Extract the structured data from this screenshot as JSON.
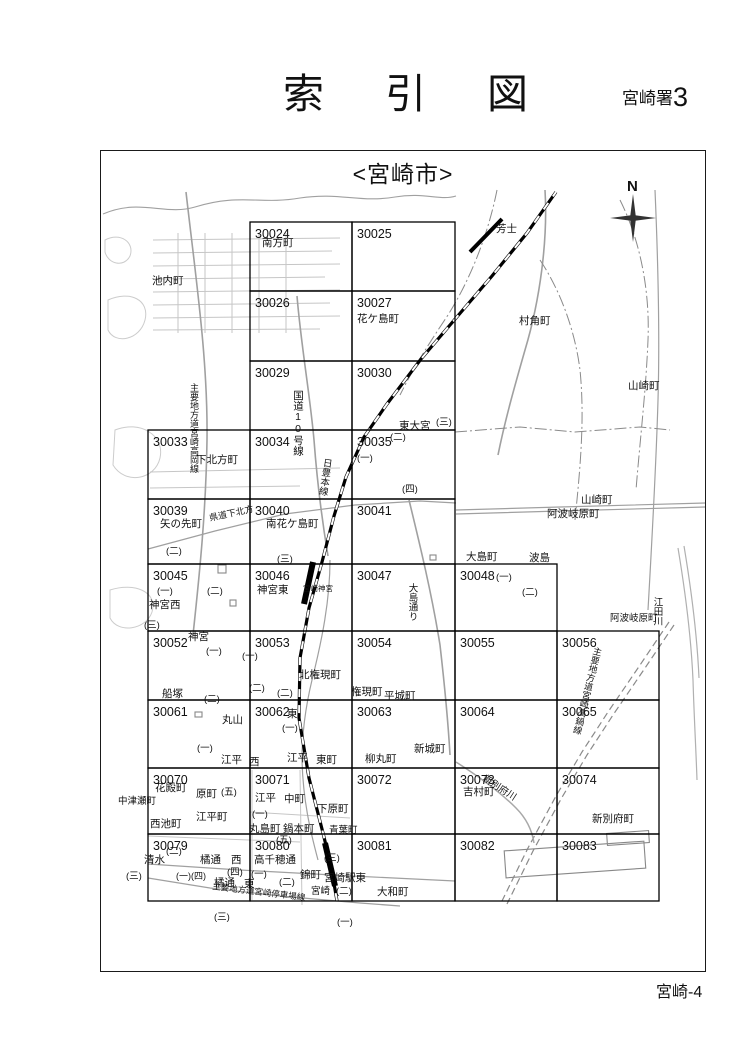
{
  "header": {
    "title": "索　引　図",
    "office": "宮崎署",
    "office_number": "3"
  },
  "map": {
    "title": "<宮崎市>",
    "compass": "N",
    "page_label": "宮崎-4"
  },
  "grid": {
    "cols": [
      148,
      250,
      352,
      455,
      557,
      659
    ],
    "rows": [
      222,
      291,
      361,
      430,
      499,
      564,
      631,
      700,
      768,
      834,
      901
    ],
    "cells": [
      {
        "no": "30024",
        "c": 1,
        "r": 0
      },
      {
        "no": "30025",
        "c": 2,
        "r": 0
      },
      {
        "no": "30026",
        "c": 1,
        "r": 1
      },
      {
        "no": "30027",
        "c": 2,
        "r": 1
      },
      {
        "no": "30029",
        "c": 1,
        "r": 2
      },
      {
        "no": "30030",
        "c": 2,
        "r": 2
      },
      {
        "no": "30033",
        "c": 0,
        "r": 3
      },
      {
        "no": "30034",
        "c": 1,
        "r": 3
      },
      {
        "no": "30035",
        "c": 2,
        "r": 3
      },
      {
        "no": "30039",
        "c": 0,
        "r": 4
      },
      {
        "no": "30040",
        "c": 1,
        "r": 4
      },
      {
        "no": "30041",
        "c": 2,
        "r": 4
      },
      {
        "no": "30045",
        "c": 0,
        "r": 5
      },
      {
        "no": "30046",
        "c": 1,
        "r": 5
      },
      {
        "no": "30047",
        "c": 2,
        "r": 5
      },
      {
        "no": "30048",
        "c": 3,
        "r": 5
      },
      {
        "no": "30052",
        "c": 0,
        "r": 6
      },
      {
        "no": "30053",
        "c": 1,
        "r": 6
      },
      {
        "no": "30054",
        "c": 2,
        "r": 6
      },
      {
        "no": "30055",
        "c": 3,
        "r": 6
      },
      {
        "no": "30056",
        "c": 4,
        "r": 6
      },
      {
        "no": "30061",
        "c": 0,
        "r": 7
      },
      {
        "no": "30062",
        "c": 1,
        "r": 7
      },
      {
        "no": "30063",
        "c": 2,
        "r": 7
      },
      {
        "no": "30064",
        "c": 3,
        "r": 7
      },
      {
        "no": "30065",
        "c": 4,
        "r": 7
      },
      {
        "no": "30070",
        "c": 0,
        "r": 8
      },
      {
        "no": "30071",
        "c": 1,
        "r": 8
      },
      {
        "no": "30072",
        "c": 2,
        "r": 8
      },
      {
        "no": "30073",
        "c": 3,
        "r": 8
      },
      {
        "no": "30074",
        "c": 4,
        "r": 8
      },
      {
        "no": "30079",
        "c": 0,
        "r": 9
      },
      {
        "no": "30080",
        "c": 1,
        "r": 9
      },
      {
        "no": "30081",
        "c": 2,
        "r": 9
      },
      {
        "no": "30082",
        "c": 3,
        "r": 9
      },
      {
        "no": "30083",
        "c": 4,
        "r": 9
      }
    ]
  },
  "labels": [
    {
      "t": "南方町",
      "x": 262,
      "y": 246
    },
    {
      "t": "池内町",
      "x": 152,
      "y": 284
    },
    {
      "t": "芳士",
      "x": 496,
      "y": 232
    },
    {
      "t": "村角町",
      "x": 519,
      "y": 324
    },
    {
      "t": "花ケ島町",
      "x": 357,
      "y": 322
    },
    {
      "t": "山崎町",
      "x": 628,
      "y": 389
    },
    {
      "t": "国道10号線",
      "x": 298,
      "y": 390,
      "v": 1
    },
    {
      "t": "主要地方道宮崎高岡線",
      "x": 194,
      "y": 383,
      "v": 1,
      "s": 9
    },
    {
      "t": "下北方町",
      "x": 196,
      "y": 463
    },
    {
      "t": "東大宮",
      "x": 399,
      "y": 429
    },
    {
      "t": "(三)",
      "x": 436,
      "y": 425,
      "s": 9.5
    },
    {
      "t": "(二)",
      "x": 390,
      "y": 440,
      "s": 9.5
    },
    {
      "t": "(一)",
      "x": 357,
      "y": 461,
      "s": 9.5
    },
    {
      "t": "(四)",
      "x": 402,
      "y": 492,
      "s": 9.5
    },
    {
      "t": "矢の先町",
      "x": 160,
      "y": 527
    },
    {
      "t": "(二)",
      "x": 166,
      "y": 554,
      "s": 9.5
    },
    {
      "t": "県道下北方",
      "x": 210,
      "y": 521,
      "r": -12,
      "s": 9
    },
    {
      "t": "南花ケ島町",
      "x": 266,
      "y": 527
    },
    {
      "t": "(三)",
      "x": 277,
      "y": 562,
      "s": 9.5
    },
    {
      "t": "日豊本線",
      "x": 327,
      "y": 458,
      "v": 1,
      "s": 9.5,
      "r": 8
    },
    {
      "t": "大島町",
      "x": 466,
      "y": 560
    },
    {
      "t": "波島",
      "x": 529,
      "y": 561
    },
    {
      "t": "阿波岐原町",
      "x": 547,
      "y": 517
    },
    {
      "t": "山崎町",
      "x": 581,
      "y": 503
    },
    {
      "t": "(一)",
      "x": 157,
      "y": 594,
      "s": 9.5
    },
    {
      "t": "神宮西",
      "x": 149,
      "y": 608
    },
    {
      "t": "(二)",
      "x": 207,
      "y": 594,
      "s": 9.5
    },
    {
      "t": "(三)",
      "x": 144,
      "y": 628,
      "s": 9.5
    },
    {
      "t": "神宮東",
      "x": 257,
      "y": 593
    },
    {
      "t": "宮崎神宮",
      "x": 303,
      "y": 591,
      "s": 7.5
    },
    {
      "t": "大島通り",
      "x": 412,
      "y": 583,
      "v": 1,
      "s": 9.5
    },
    {
      "t": "(一)",
      "x": 496,
      "y": 580,
      "s": 9.5
    },
    {
      "t": "(二)",
      "x": 522,
      "y": 595,
      "s": 9.5
    },
    {
      "t": "阿波岐原町",
      "x": 610,
      "y": 621,
      "s": 9.5
    },
    {
      "t": "江田川",
      "x": 657,
      "y": 597,
      "v": 1,
      "s": 9.5
    },
    {
      "t": "神宮",
      "x": 188,
      "y": 640
    },
    {
      "t": "(一)",
      "x": 206,
      "y": 654,
      "s": 9.5
    },
    {
      "t": "(一)",
      "x": 242,
      "y": 659,
      "s": 9.5
    },
    {
      "t": "(二)",
      "x": 249,
      "y": 691,
      "s": 9.5
    },
    {
      "t": "(二)",
      "x": 277,
      "y": 696,
      "s": 9.5
    },
    {
      "t": "北権現町",
      "x": 299,
      "y": 678
    },
    {
      "t": "船塚",
      "x": 162,
      "y": 697
    },
    {
      "t": "(二)",
      "x": 204,
      "y": 702,
      "s": 9.5
    },
    {
      "t": "権現町",
      "x": 351,
      "y": 695
    },
    {
      "t": "平城町",
      "x": 384,
      "y": 699
    },
    {
      "t": "丸山",
      "x": 222,
      "y": 723
    },
    {
      "t": "東",
      "x": 287,
      "y": 717
    },
    {
      "t": "(一)",
      "x": 282,
      "y": 731,
      "s": 9.5
    },
    {
      "t": "新城町",
      "x": 414,
      "y": 752
    },
    {
      "t": "柳丸町",
      "x": 365,
      "y": 762
    },
    {
      "t": "(一)",
      "x": 197,
      "y": 751,
      "s": 9.5
    },
    {
      "t": "江平",
      "x": 221,
      "y": 763
    },
    {
      "t": "西",
      "x": 249,
      "y": 765
    },
    {
      "t": "江平",
      "x": 287,
      "y": 761
    },
    {
      "t": "東町",
      "x": 316,
      "y": 763
    },
    {
      "t": "主要地方道宮崎高鍋線",
      "x": 598,
      "y": 647,
      "v": 1,
      "s": 9,
      "r": 14
    },
    {
      "t": "花殿町",
      "x": 155,
      "y": 791
    },
    {
      "t": "原町",
      "x": 196,
      "y": 797
    },
    {
      "t": "(五)",
      "x": 221,
      "y": 795,
      "s": 9.5
    },
    {
      "t": "中津瀬町",
      "x": 118,
      "y": 804,
      "s": 9.5
    },
    {
      "t": "江平町",
      "x": 196,
      "y": 820
    },
    {
      "t": "西池町",
      "x": 150,
      "y": 827
    },
    {
      "t": "(五)",
      "x": 276,
      "y": 843,
      "s": 9.5
    },
    {
      "t": "江平",
      "x": 255,
      "y": 801
    },
    {
      "t": "中町",
      "x": 284,
      "y": 802
    },
    {
      "t": "(一)",
      "x": 252,
      "y": 817,
      "s": 9.5
    },
    {
      "t": "丸島町",
      "x": 249,
      "y": 832
    },
    {
      "t": "鍋本町",
      "x": 283,
      "y": 832
    },
    {
      "t": "下原町",
      "x": 317,
      "y": 812
    },
    {
      "t": "青葉町",
      "x": 329,
      "y": 833,
      "s": 9.5
    },
    {
      "t": "新別府川",
      "x": 482,
      "y": 780,
      "r": 33,
      "s": 9.5
    },
    {
      "t": "吉村町",
      "x": 463,
      "y": 795
    },
    {
      "t": "新別府町",
      "x": 592,
      "y": 822
    },
    {
      "t": "(二)",
      "x": 166,
      "y": 854,
      "s": 9.5
    },
    {
      "t": "清水",
      "x": 144,
      "y": 863
    },
    {
      "t": "橘通",
      "x": 200,
      "y": 863
    },
    {
      "t": "西",
      "x": 231,
      "y": 863
    },
    {
      "t": "(一)(四)",
      "x": 176,
      "y": 879,
      "s": 9
    },
    {
      "t": "(四)",
      "x": 227,
      "y": 875,
      "s": 9.5
    },
    {
      "t": "橘通",
      "x": 214,
      "y": 886
    },
    {
      "t": "東",
      "x": 244,
      "y": 887
    },
    {
      "t": "(三)",
      "x": 126,
      "y": 879,
      "s": 9.5
    },
    {
      "t": "高千穂通",
      "x": 254,
      "y": 863
    },
    {
      "t": "(一)",
      "x": 251,
      "y": 877,
      "s": 9.5
    },
    {
      "t": "(二)",
      "x": 279,
      "y": 885,
      "s": 9.5
    },
    {
      "t": "錦町",
      "x": 300,
      "y": 878
    },
    {
      "t": "宮崎駅東",
      "x": 324,
      "y": 881
    },
    {
      "t": "宮崎",
      "x": 311,
      "y": 894,
      "s": 9.5
    },
    {
      "t": "(二)",
      "x": 336,
      "y": 894,
      "s": 9.5
    },
    {
      "t": "(三)",
      "x": 324,
      "y": 861,
      "s": 9.5
    },
    {
      "t": "大和町",
      "x": 377,
      "y": 895
    },
    {
      "t": "主要地方道宮崎停車場線",
      "x": 212,
      "y": 889,
      "r": 7,
      "s": 8.5
    },
    {
      "t": "(三)",
      "x": 214,
      "y": 920,
      "s": 9.5
    },
    {
      "t": "(一)",
      "x": 337,
      "y": 925,
      "s": 9.5
    }
  ]
}
